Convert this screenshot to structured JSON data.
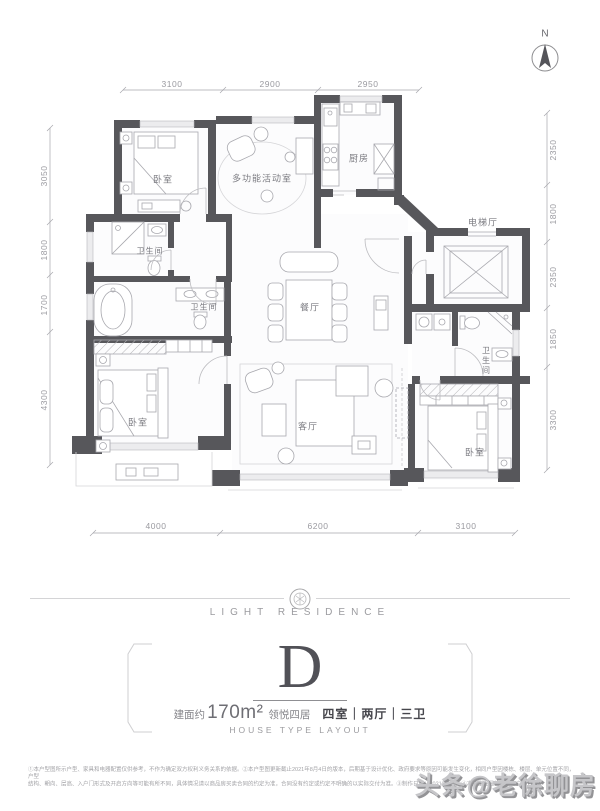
{
  "compass": {
    "north": "N"
  },
  "dimensions": {
    "top": [
      "3100",
      "2900",
      "2950"
    ],
    "bottom": [
      "4000",
      "6200",
      "3100"
    ],
    "left": [
      "3050",
      "1800",
      "1700",
      "4300"
    ],
    "right": [
      "2350",
      "1800",
      "2350",
      "1850",
      "3300"
    ]
  },
  "rooms": {
    "bedroom_top_left": "卧室",
    "multi_function": "多功能活动室",
    "kitchen": "厨房",
    "elevator_hall": "电梯厅",
    "bath_upper": "卫生间",
    "bath_master": "卫生间",
    "bath_right": "卫生间",
    "dining": "餐厅",
    "living": "客厅",
    "bedroom_bottom_left": "卧室",
    "bedroom_bottom_right": "卧室"
  },
  "branding": {
    "logo": "LIGHT RESIDENCE",
    "unit": "D",
    "area_prefix": "建面约",
    "area_value": "170m²",
    "series": "领悦四居",
    "spec": "四室｜两厅｜三卫",
    "subtitle": "HOUSE TYPE LAYOUT"
  },
  "footer": {
    "disclaimer_line1": "①本户型图所示户型、家具和电器配置仅供参考，不作为确定双方权利义务关系的依据。②本户型图更新截止2021年8月4日的版本，后期基于设计优化、政府要求等原因可能发生变化，相同户型因楼栋、楼层、单元位置不同，户型",
    "disclaimer_line2": "结构、朝向、层高、入户门形式及开启方向等可能有所不同，具体情况请以商品房买卖合同的约定为准，合同没有约定或约定不明确的以实际交付为准。③制作日期：2021年8月。④本户型图最终以实际交付为准。",
    "watermark": "头条@老徐聊房"
  }
}
